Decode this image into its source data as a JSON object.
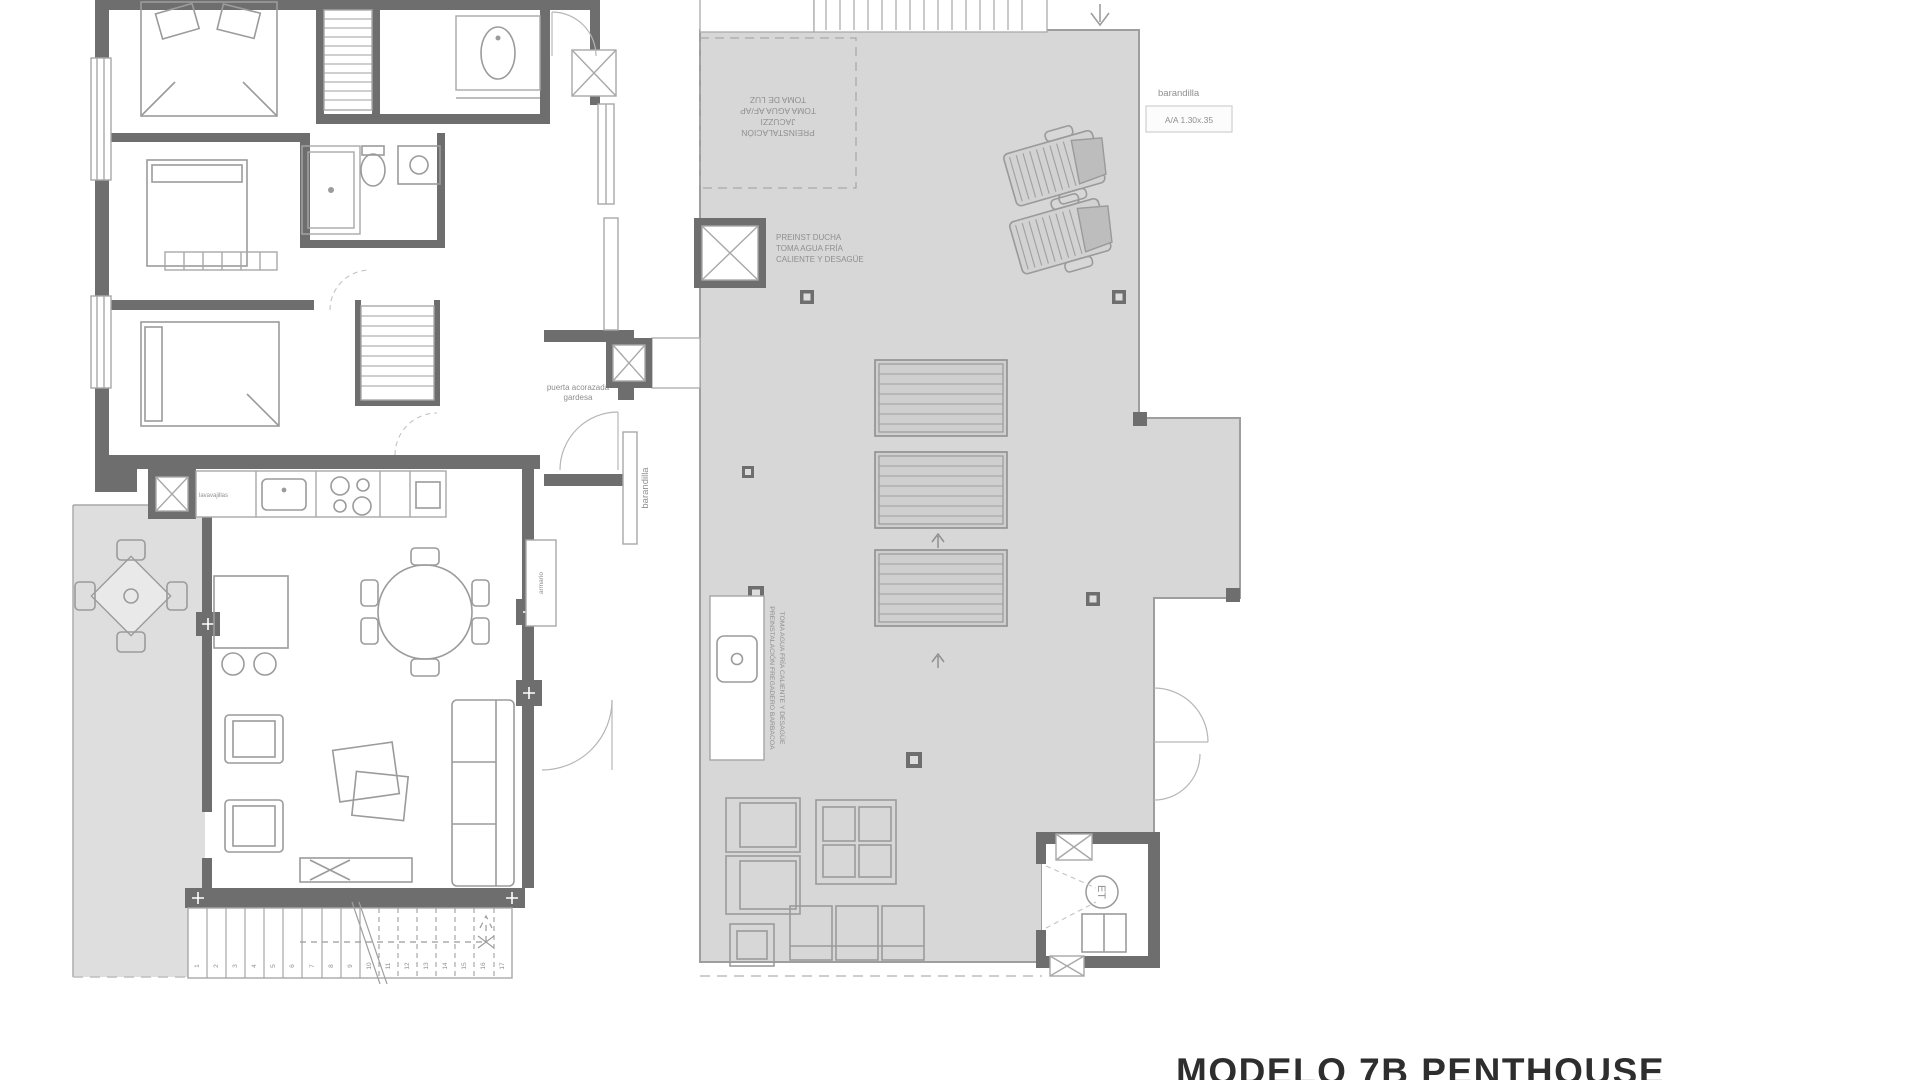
{
  "title": {
    "text": "MODELO 7B PENTHOUSE"
  },
  "plan_left": {
    "labels": {
      "barandilla_upper": "barandilla",
      "barandilla_lower": "barandilla",
      "entrance_line1": "puerta acorazada",
      "entrance_line2": "gardesa",
      "dishwasher": "lavavajillas",
      "closet": "armario"
    },
    "stairs": {
      "numbers": [
        "1",
        "2",
        "3",
        "4",
        "5",
        "6",
        "7",
        "8",
        "9",
        "10",
        "11",
        "12",
        "13",
        "14",
        "15",
        "16",
        "17"
      ]
    }
  },
  "plan_right": {
    "labels": {
      "barandilla": "barandilla",
      "ac_unit": "A/A 1.30x.35",
      "jacuzzi_line1": "PREINSTALACIÓN",
      "jacuzzi_line2": "JACUZZI",
      "jacuzzi_line3": "TOMA AGUA AF/AP",
      "jacuzzi_line4": "TOMA DE LUZ",
      "shower_line1": "PREINST DUCHA",
      "shower_line2": "TOMA AGUA FRÍA",
      "shower_line3": "CALIENTE Y DESAGÜE",
      "barbecue_line1": "PREINSTALACIÓN FREGADERO BARBACOA",
      "barbecue_line2": "TOMA AGUA FRÍA CALIENTE Y DESAGÜE",
      "telecom": "ET"
    }
  },
  "colors": {
    "wall": "#6e6e6e",
    "floor_gray": "#d7d7d7",
    "terrace_gray": "#dedede",
    "line": "#a8a8a8",
    "text": "#8f8f8f",
    "title": "#2e2e2e"
  }
}
